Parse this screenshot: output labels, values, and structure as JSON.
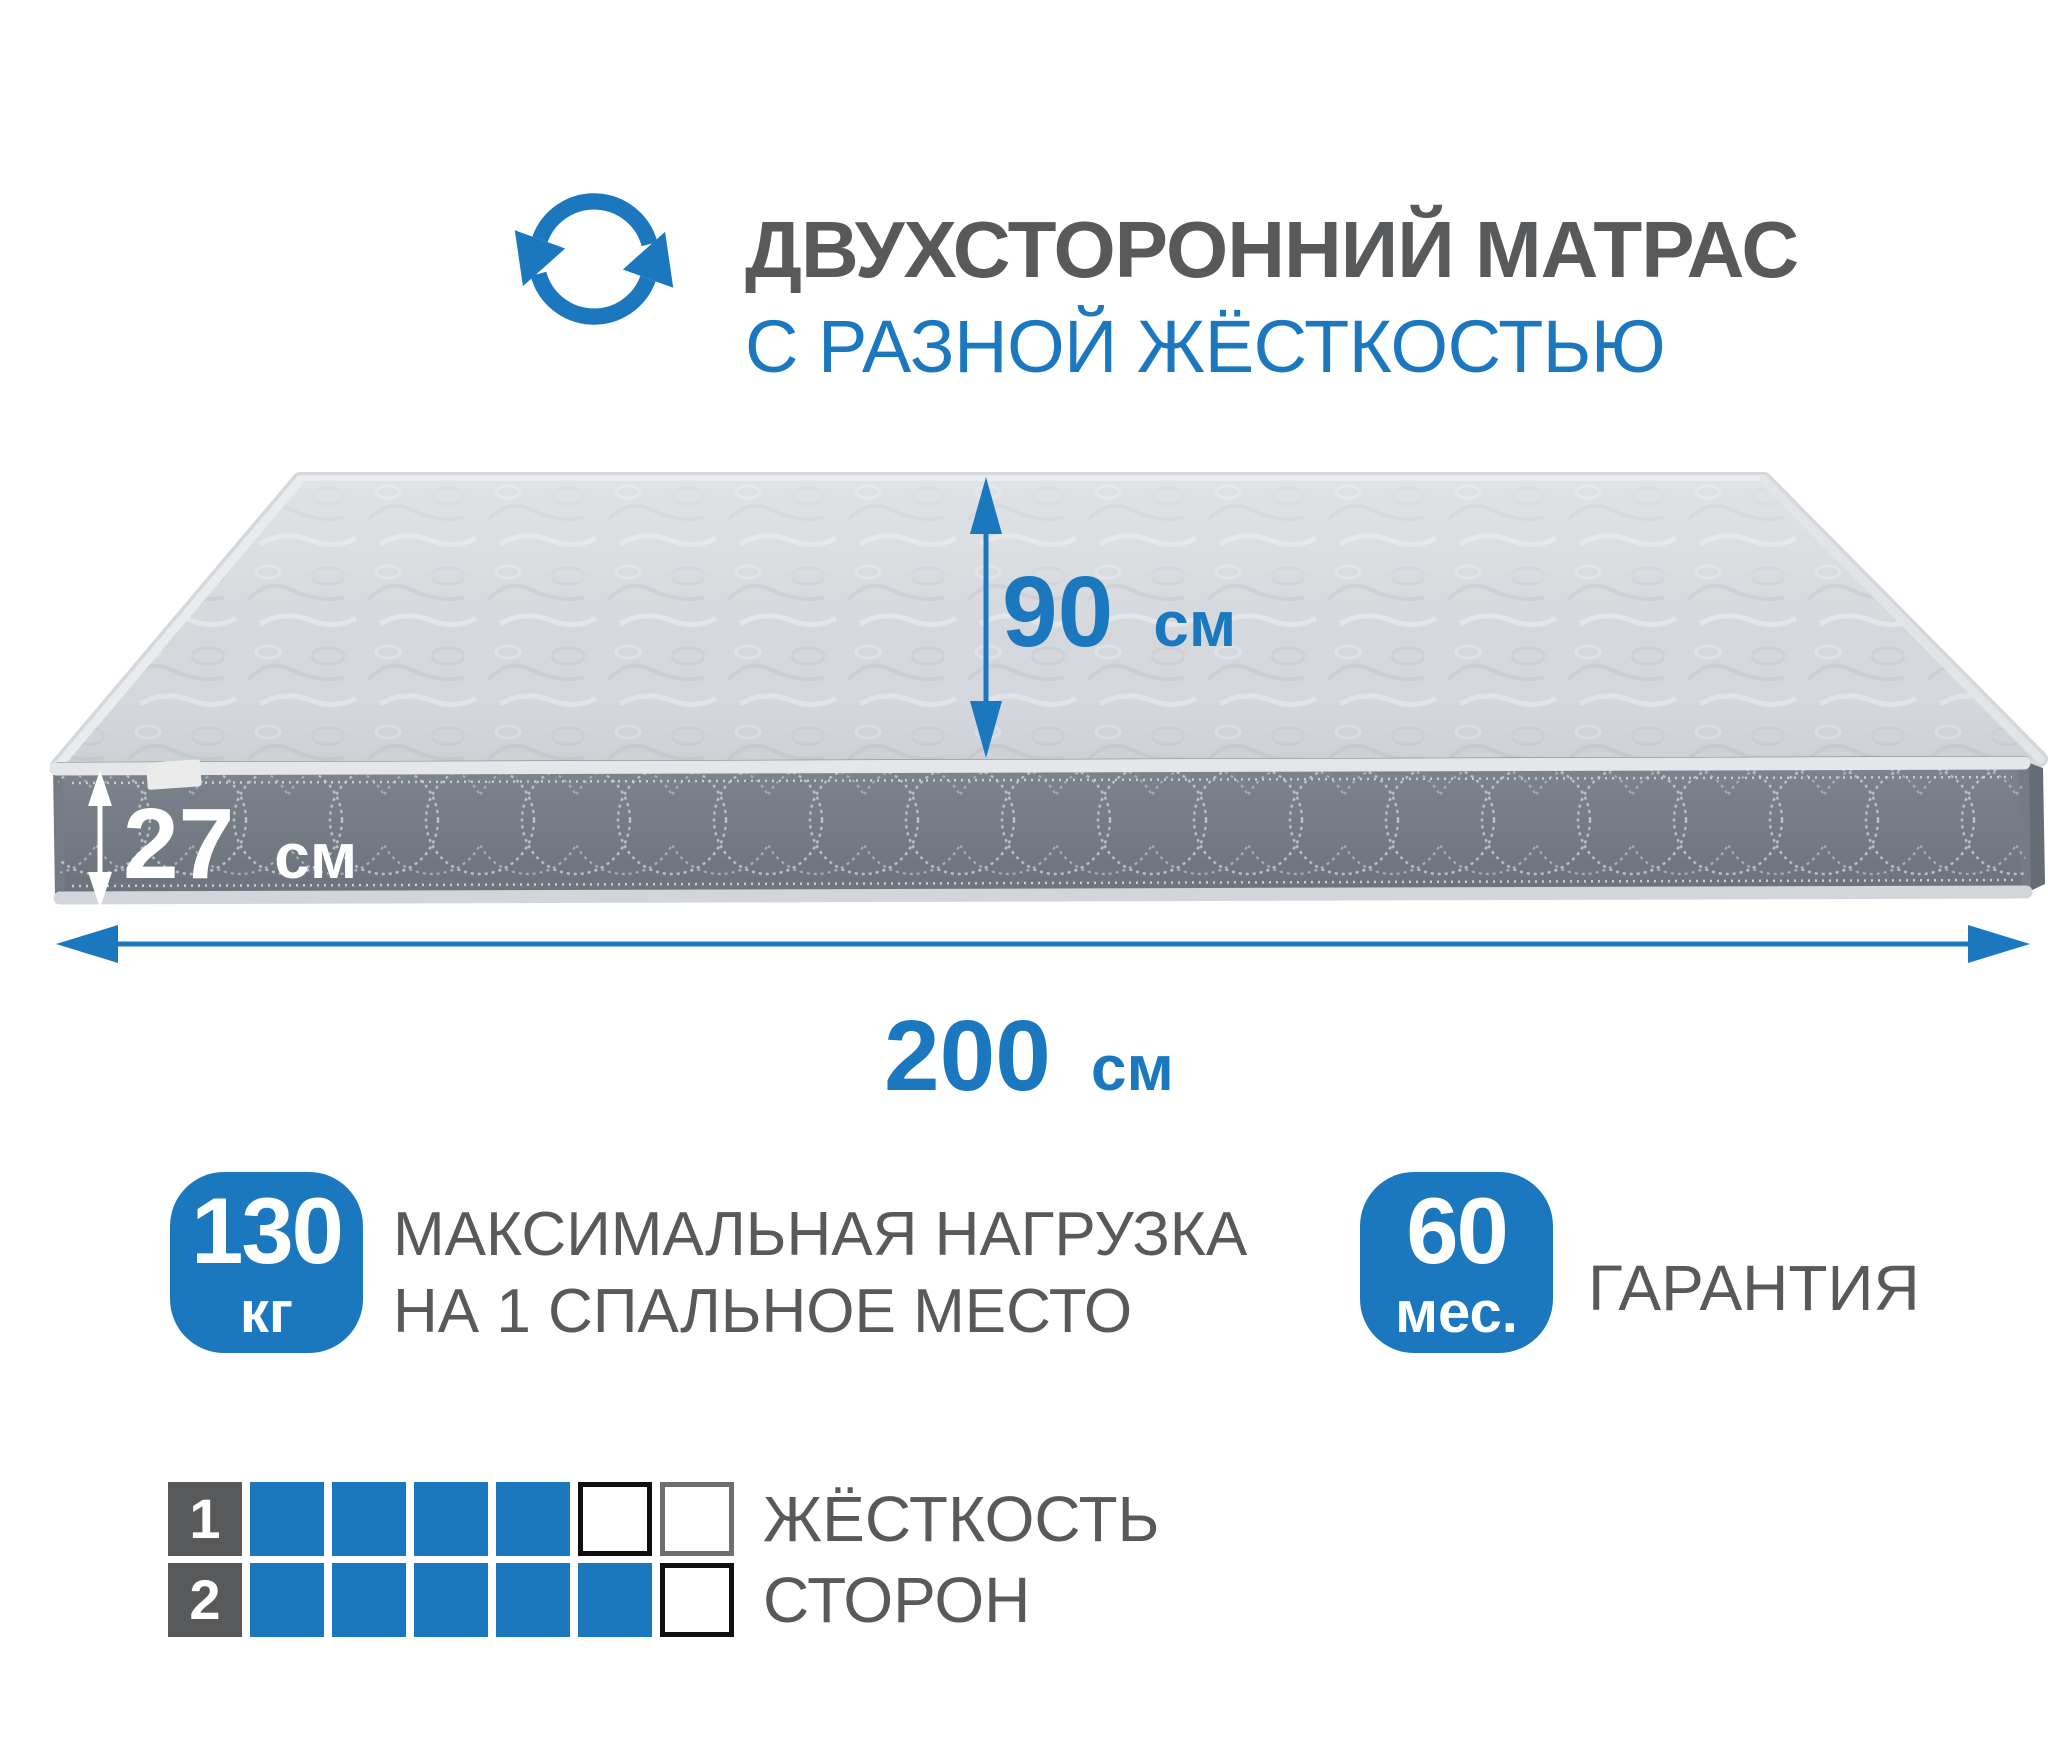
{
  "colors": {
    "accent": "#1b78be",
    "heading_gray": "#58595b",
    "mattress_top": "#d4d8dc",
    "mattress_side": "#747b84",
    "stitch": "#b9bfc7"
  },
  "header": {
    "icon": "rotate-arrows-icon",
    "title": "ДВУХСТОРОННИЙ МАТРАС",
    "subtitle": "С РАЗНОЙ ЖЁСТКОСТЬЮ"
  },
  "dimensions": {
    "width": {
      "value": "90",
      "unit": "см"
    },
    "thickness": {
      "value": "27",
      "unit": "см"
    },
    "length": {
      "value": "200",
      "unit": "см"
    }
  },
  "load_badge": {
    "value": "130",
    "unit": "кг",
    "line1": "МАКСИМАЛЬНАЯ НАГРУЗКА",
    "line2": "НА 1 СПАЛЬНОЕ МЕСТО"
  },
  "warranty_badge": {
    "value": "60",
    "unit": "мес.",
    "label": "ГАРАНТИЯ"
  },
  "firmness": {
    "label_line1": "ЖЁСТКОСТЬ",
    "label_line2": "СТОРОН",
    "rows": [
      {
        "number": "1",
        "cells": [
          "filled",
          "filled",
          "filled",
          "filled",
          "empty-black",
          "empty-gray"
        ]
      },
      {
        "number": "2",
        "cells": [
          "filled",
          "filled",
          "filled",
          "filled",
          "filled",
          "empty-black"
        ]
      }
    ]
  }
}
